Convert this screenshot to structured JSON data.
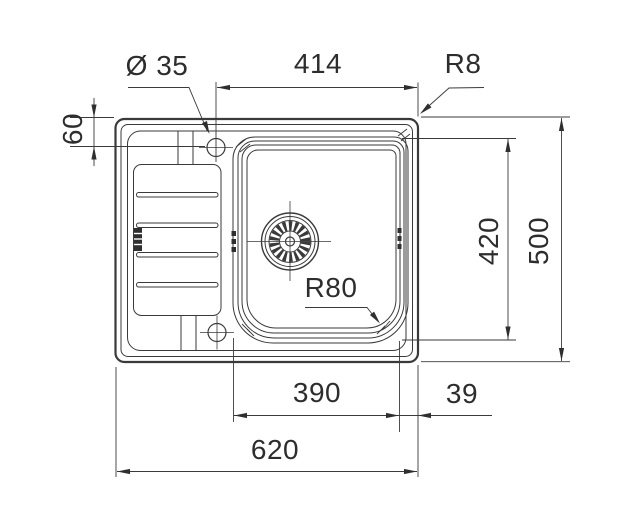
{
  "drawing": {
    "kind": "technical-dimension-drawing",
    "subject": "inset kitchen sink, top view, left drainboard and right bowl with strainer waste",
    "colors": {
      "line": "#3a3a3a",
      "text": "#2d2d2d",
      "background": "#ffffff"
    }
  },
  "dimensions": {
    "tap_hole_diameter": {
      "label": "Ø 35",
      "value": 35,
      "kind": "diameter",
      "target": "tap-hole"
    },
    "inner_top_width": {
      "label": "414",
      "value": 414,
      "kind": "linear-horizontal",
      "target": "tap-hole-center to right edge"
    },
    "rim_corner_radius": {
      "label": "R8",
      "value": 8,
      "kind": "radius",
      "target": "outer rim corner"
    },
    "tap_hole_offset": {
      "label": "60",
      "value": 60,
      "kind": "linear-vertical",
      "target": "top edge to tap-hole center"
    },
    "bowl_length": {
      "label": "420",
      "value": 420,
      "kind": "linear-vertical",
      "target": "bowl front-to-back"
    },
    "overall_depth": {
      "label": "500",
      "value": 500,
      "kind": "linear-vertical",
      "target": "overall front-to-back"
    },
    "bowl_corner_radius": {
      "label": "R80",
      "value": 80,
      "kind": "radius",
      "target": "bowl corner"
    },
    "bowl_width": {
      "label": "390",
      "value": 390,
      "kind": "linear-horizontal",
      "target": "bowl width"
    },
    "edge_gap": {
      "label": "39",
      "value": 39,
      "kind": "linear-horizontal",
      "target": "bowl to right edge"
    },
    "overall_width": {
      "label": "620",
      "value": 620,
      "kind": "linear-horizontal",
      "target": "overall width"
    }
  }
}
